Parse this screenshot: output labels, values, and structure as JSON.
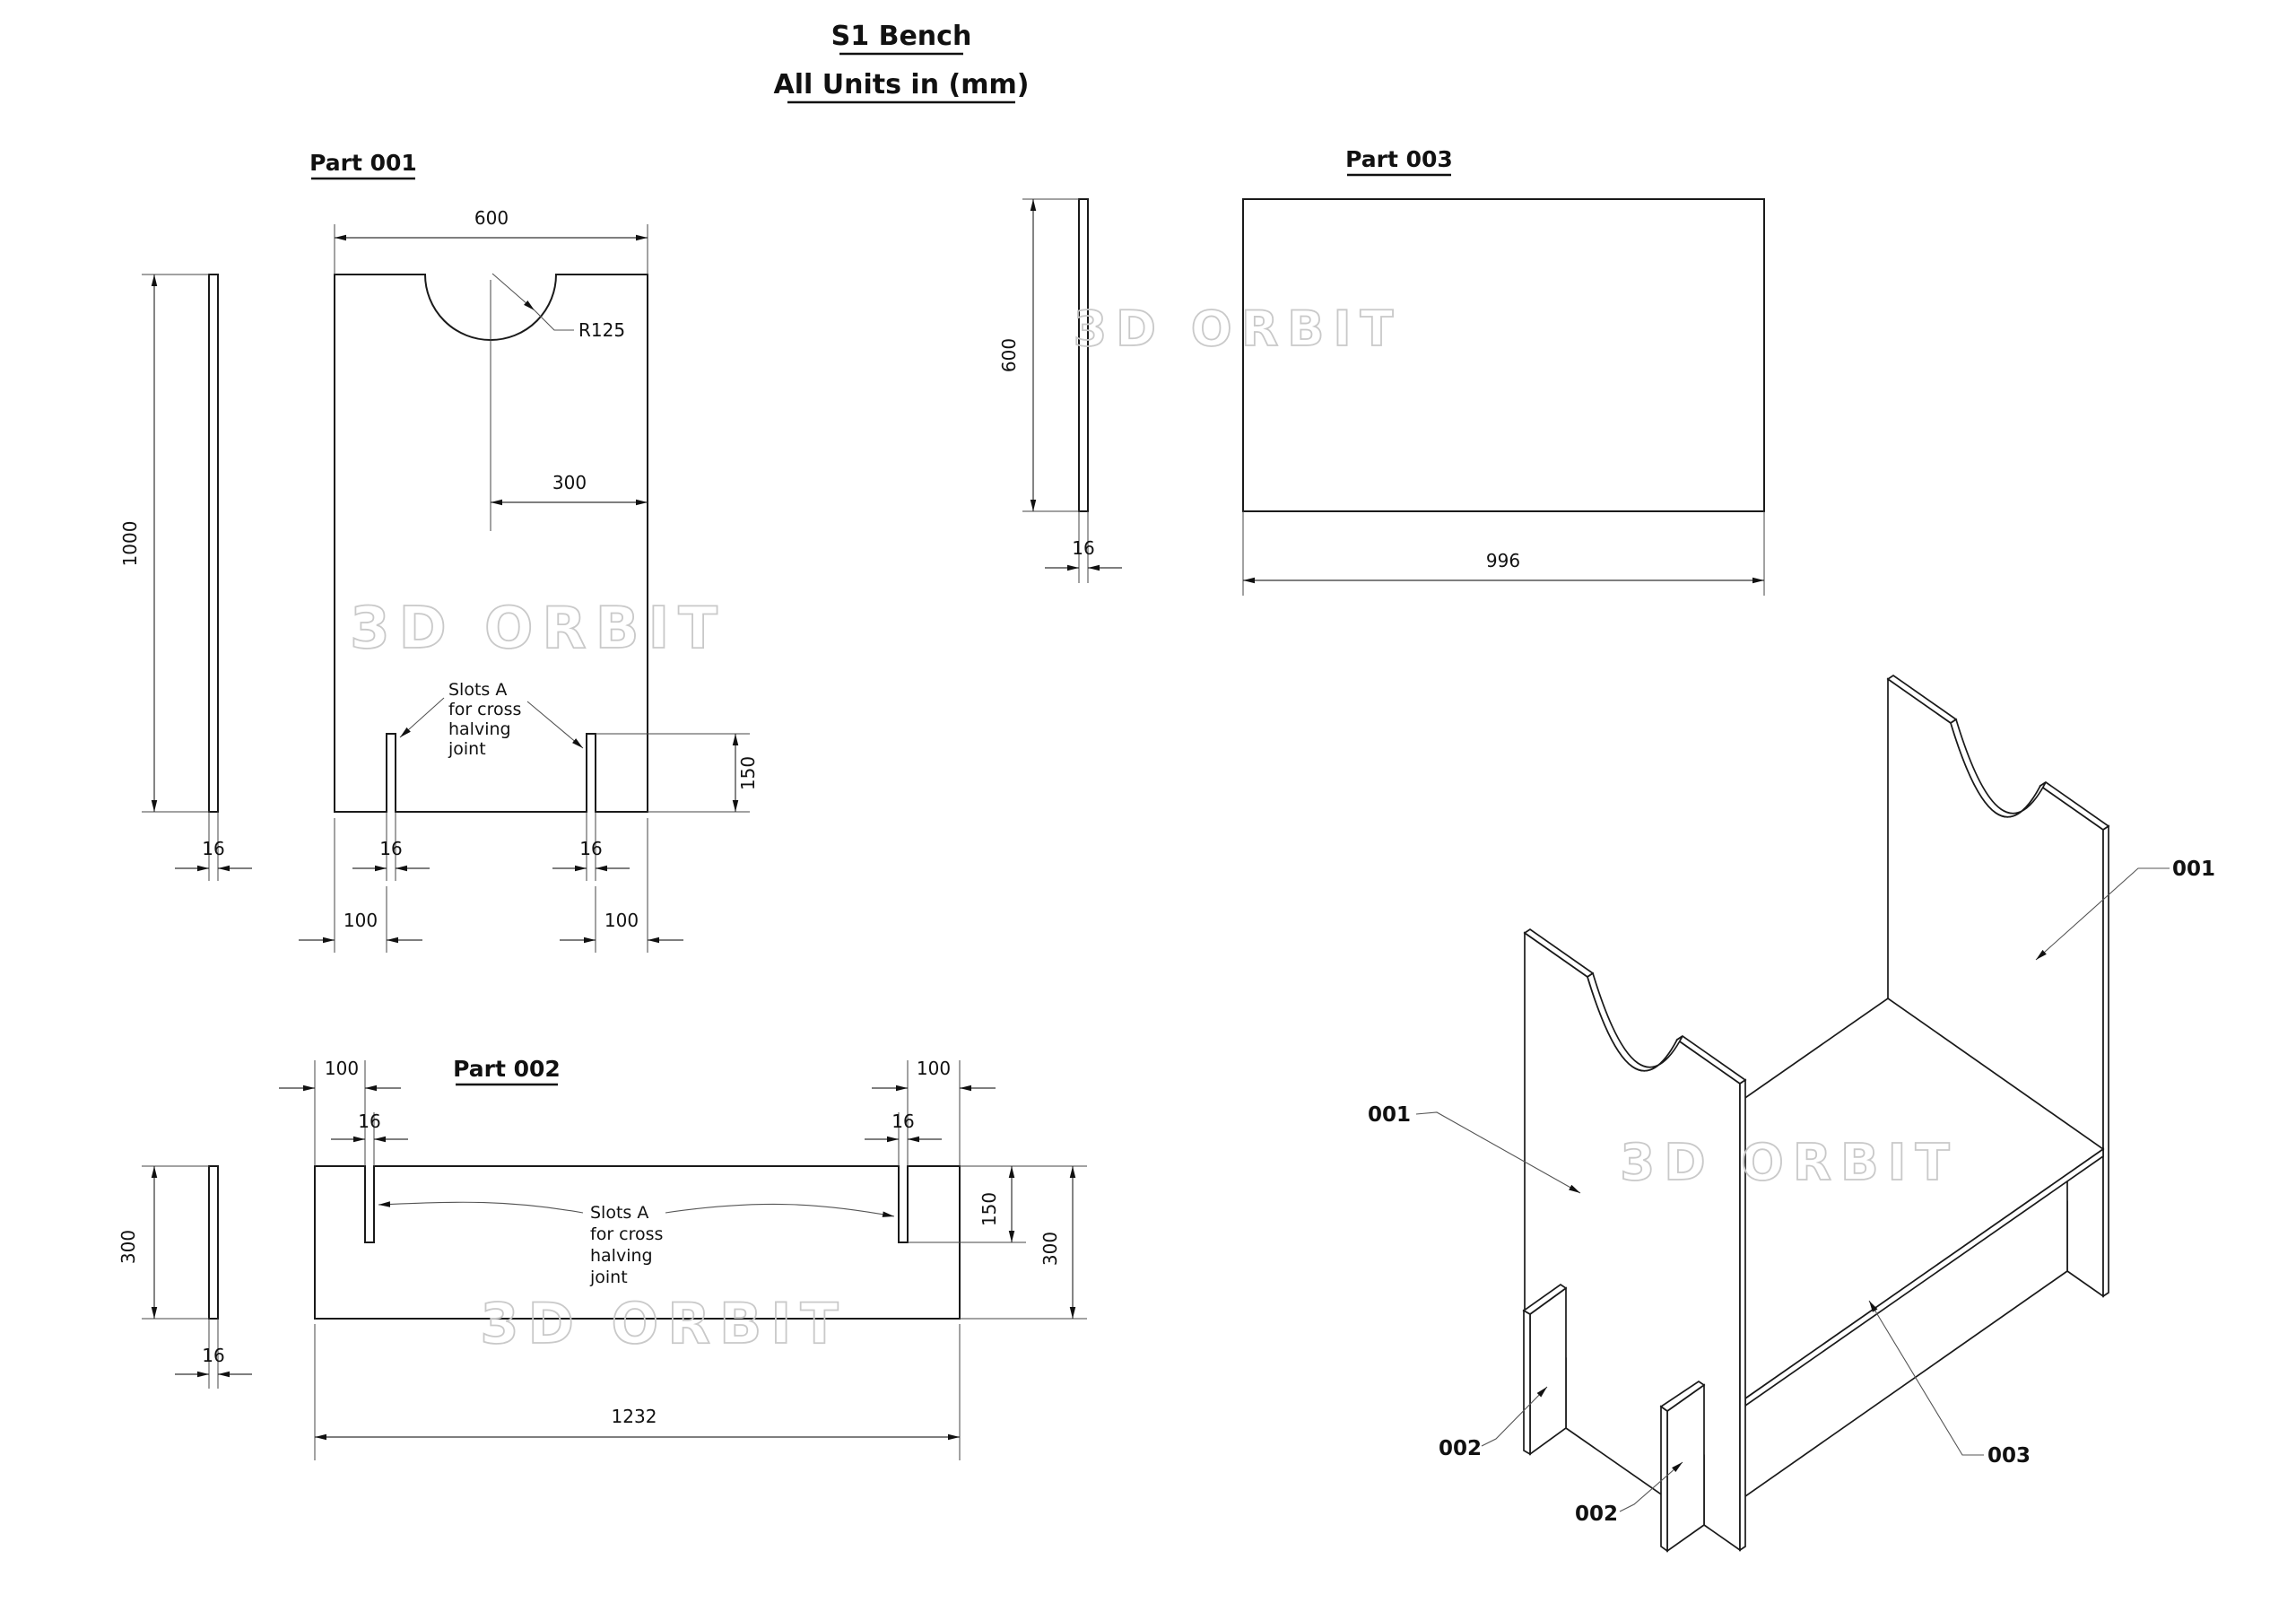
{
  "title": {
    "line1": "S1 Bench",
    "line2": "All Units in (mm)"
  },
  "watermark": "3D ORBIT",
  "p1": {
    "label": "Part 001",
    "d_width": "600",
    "d_radius": "R125",
    "d_center": "300",
    "d_height": "1000",
    "d_thick": "16",
    "d_slot_l": "16",
    "d_slot_r": "16",
    "d_off_l": "100",
    "d_off_r": "100",
    "d_slot_depth": "150",
    "note": {
      "l1": "Slots A",
      "l2": "for cross",
      "l3": "halving",
      "l4": "joint"
    }
  },
  "p2": {
    "label": "Part 002",
    "d_height": "300",
    "d_thick": "16",
    "d_len": "1232",
    "d_off_l": "100",
    "d_off_r": "100",
    "d_slot_l": "16",
    "d_slot_r": "16",
    "d_slot_depth": "150",
    "d_total_h": "300",
    "note": {
      "l1": "Slots A",
      "l2": "for cross",
      "l3": "halving",
      "l4": "joint"
    }
  },
  "p3": {
    "label": "Part 003",
    "d_height": "600",
    "d_thick": "16",
    "d_len": "996"
  },
  "iso": {
    "l001a": "001",
    "l001b": "001",
    "l002a": "002",
    "l002b": "002",
    "l003": "003"
  }
}
